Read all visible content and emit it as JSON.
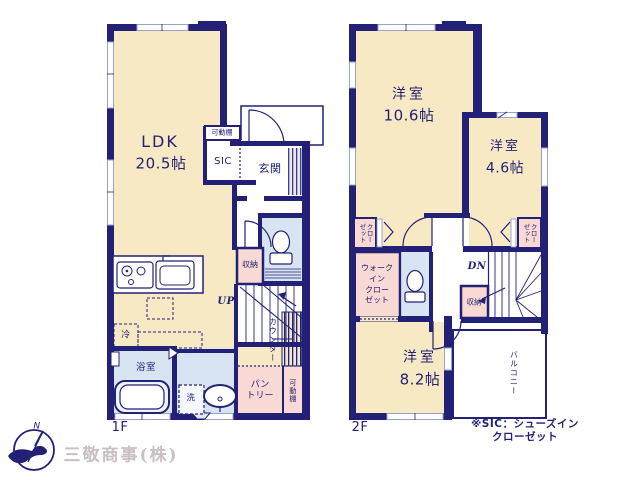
{
  "palette": {
    "wall_navy": "#232175",
    "room_cream": "#f8e9c5",
    "room_pink": "#f8d9d3",
    "room_blue": "#d9e4f2",
    "logo_gray": "#c9bfc4"
  },
  "floor1": {
    "label": "1F",
    "ldk": {
      "name": "LDK",
      "size": "20.5帖"
    },
    "shelf_top": "可動棚",
    "sic": "SIC",
    "entrance": "玄関",
    "storage": "収納",
    "stairs": "UP",
    "counter": "カウンター",
    "fridge": "冷",
    "bath": "浴室",
    "laundry": "洗",
    "pantry": "パン\nトリー",
    "shelf_bottom": "可動棚"
  },
  "floor2": {
    "label": "2F",
    "room_large": {
      "name": "洋室",
      "size": "10.6帖"
    },
    "room_small": {
      "name": "洋室",
      "size": "4.6帖"
    },
    "room_mid": {
      "name": "洋室",
      "size": "8.2帖"
    },
    "closet_left": "クロー\nゼット",
    "closet_right": "クロー\nゼット",
    "walk_in_closet": "ウォーク\nイン\nクロー\nゼット",
    "stairs": "DN",
    "storage": "収納",
    "balcony": "バルコニー"
  },
  "footer": {
    "note": "※SIC：シューズインクローゼット",
    "company": "三敬商事(株)",
    "compass": "N"
  }
}
